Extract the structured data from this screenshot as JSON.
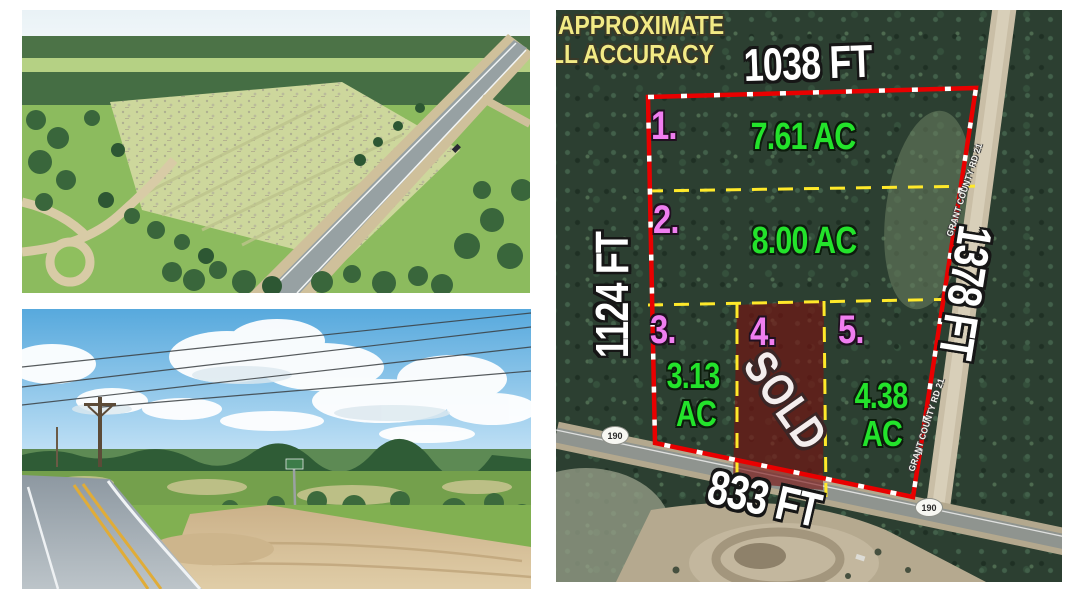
{
  "map": {
    "disclaimer": {
      "line1": "APPROXIMATE",
      "line2": "LL ACCURACY"
    },
    "dimensions": {
      "top": "1038 FT",
      "left": "1124 FT",
      "right": "1378 FT",
      "bottom": "833 FT"
    },
    "lots": [
      {
        "number": "1.",
        "acreage": "7.61 AC"
      },
      {
        "number": "2.",
        "acreage": "8.00 AC"
      },
      {
        "number": "3.",
        "acreage_line1": "3.13",
        "acreage_line2": "AC"
      },
      {
        "number": "4.",
        "status": "SOLD"
      },
      {
        "number": "5.",
        "acreage_line1": "4.38",
        "acreage_line2": "AC"
      }
    ],
    "road_labels": {
      "shield_left": "190",
      "shield_right": "190",
      "county_road_upper": "GRANT COUNTY RD 21",
      "county_road_lower": "GRANT COUNTY RD 21"
    },
    "colors": {
      "boundary_red": "#e90000",
      "divider_yellow": "#ffe92a",
      "lot_number_pink": "#f07ef0",
      "acreage_green": "#23e32b",
      "sold_fill_maroon": "rgba(122,16,16,0.62)",
      "dimension_white": "#ffffff",
      "disclaimer_yellow": "#f2ea85"
    }
  }
}
